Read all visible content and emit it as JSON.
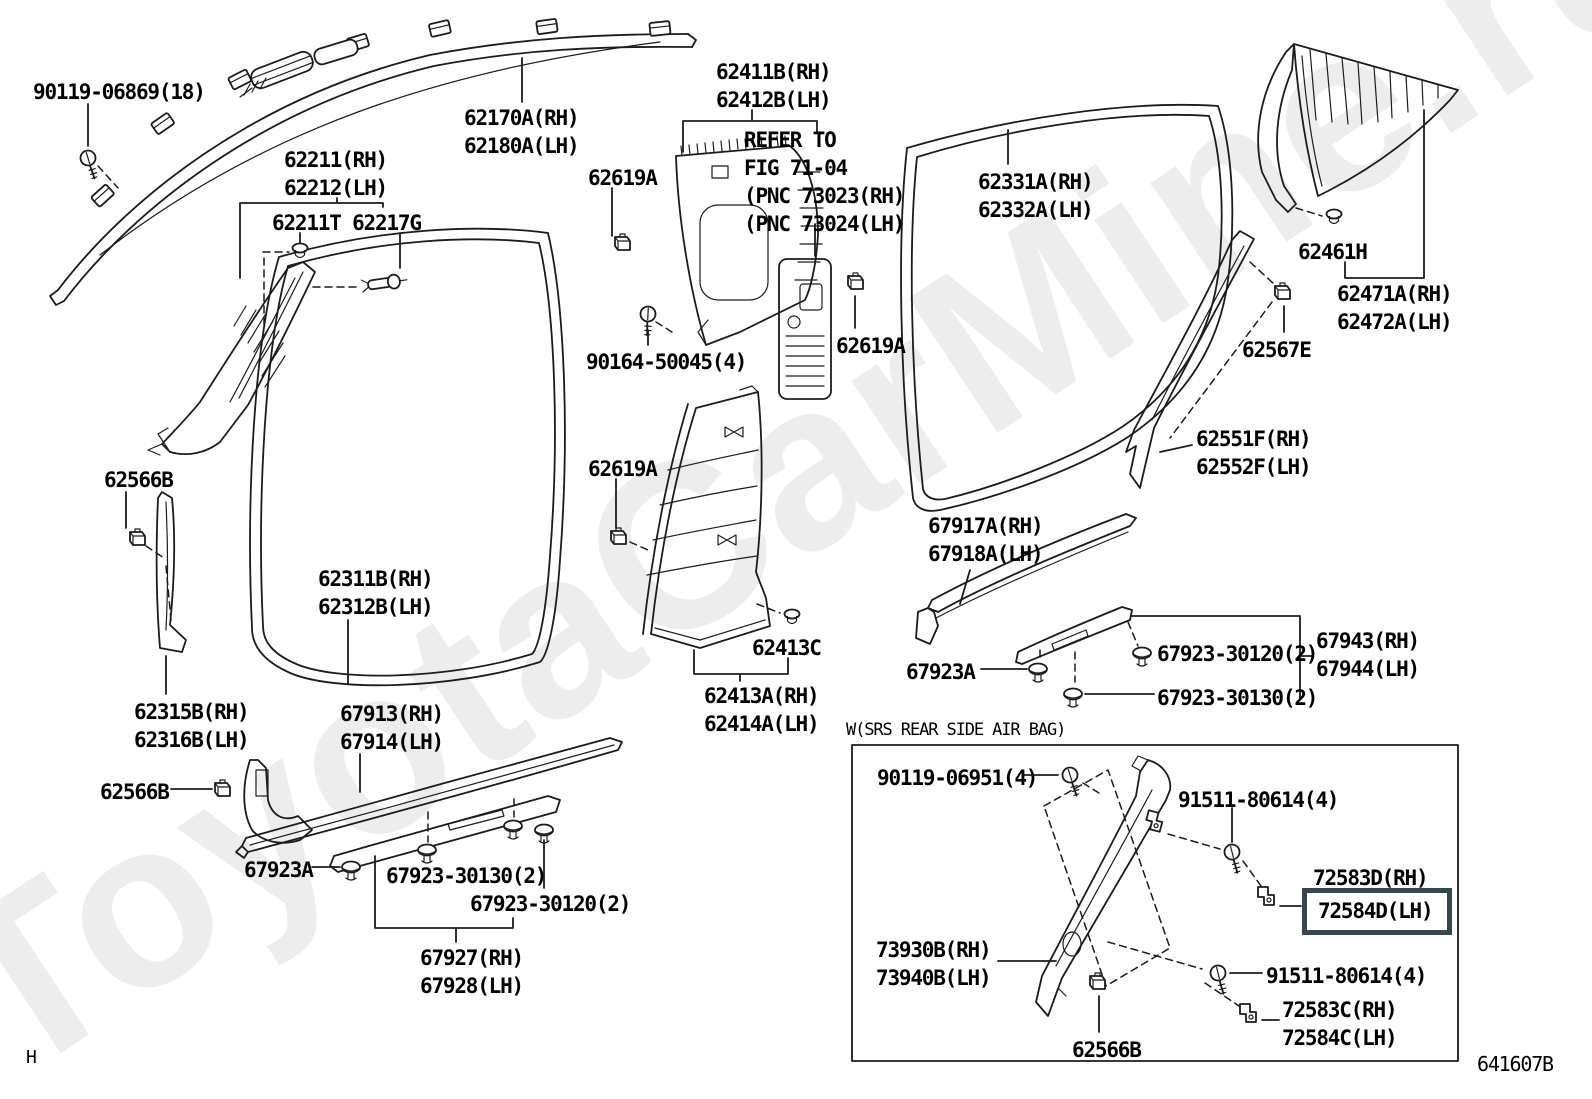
{
  "page": {
    "background": "#ffffff",
    "line_color": "#1c1c1c",
    "watermark_text": "ToyotaCarMine.ru",
    "watermark_color": "#ededed",
    "highlight_box_color": "#37474f",
    "page_code": "641607B",
    "corner_marker": "H"
  },
  "labels": [
    {
      "id": "90119-06869",
      "x": 33,
      "y": 78,
      "style": "part",
      "text": [
        "90119-06869(18)"
      ]
    },
    {
      "id": "62170A-62180A",
      "x": 464,
      "y": 104,
      "style": "part",
      "text": [
        "62170A(RH)",
        "62180A(LH)"
      ]
    },
    {
      "id": "62211-62212",
      "x": 284,
      "y": 146,
      "style": "part",
      "text": [
        "62211(RH)",
        "62212(LH)"
      ]
    },
    {
      "id": "62211T-62217G",
      "x": 272,
      "y": 209,
      "style": "part",
      "text": [
        "62211T 62217G"
      ]
    },
    {
      "id": "62411B-62412B",
      "x": 716,
      "y": 58,
      "style": "part",
      "text": [
        "62411B(RH)",
        "62412B(LH)"
      ]
    },
    {
      "id": "refer-note",
      "x": 744,
      "y": 126,
      "style": "note",
      "text": [
        "REFER TO",
        "FIG 71-04",
        "(PNC 73023(RH)",
        "(PNC 73024(LH)"
      ]
    },
    {
      "id": "62619A-1",
      "x": 588,
      "y": 164,
      "style": "part",
      "text": [
        "62619A"
      ]
    },
    {
      "id": "62331A-62332A",
      "x": 978,
      "y": 168,
      "style": "part",
      "text": [
        "62331A(RH)",
        "62332A(LH)"
      ]
    },
    {
      "id": "62461H",
      "x": 1298,
      "y": 238,
      "style": "part",
      "text": [
        "62461H"
      ]
    },
    {
      "id": "62471A-62472A",
      "x": 1337,
      "y": 280,
      "style": "part",
      "text": [
        "62471A(RH)",
        "62472A(LH)"
      ]
    },
    {
      "id": "62567E",
      "x": 1242,
      "y": 336,
      "style": "part",
      "text": [
        "62567E"
      ]
    },
    {
      "id": "62619A-2",
      "x": 836,
      "y": 332,
      "style": "part",
      "text": [
        "62619A"
      ]
    },
    {
      "id": "90164-50045",
      "x": 586,
      "y": 348,
      "style": "part",
      "text": [
        "90164-50045(4)"
      ]
    },
    {
      "id": "62551F-62552F",
      "x": 1196,
      "y": 425,
      "style": "part",
      "text": [
        "62551F(RH)",
        "62552F(LH)"
      ]
    },
    {
      "id": "62619A-3",
      "x": 588,
      "y": 455,
      "style": "part",
      "text": [
        "62619A"
      ]
    },
    {
      "id": "62566B-1",
      "x": 104,
      "y": 466,
      "style": "part",
      "text": [
        "62566B"
      ]
    },
    {
      "id": "67917A-67918A",
      "x": 928,
      "y": 512,
      "style": "part",
      "text": [
        "67917A(RH)",
        "67918A(LH)"
      ]
    },
    {
      "id": "62311B-62312B",
      "x": 318,
      "y": 565,
      "style": "part",
      "text": [
        "62311B(RH)",
        "62312B(LH)"
      ]
    },
    {
      "id": "62413C",
      "x": 752,
      "y": 634,
      "style": "part",
      "text": [
        "62413C"
      ]
    },
    {
      "id": "67943-67944",
      "x": 1316,
      "y": 627,
      "style": "part",
      "text": [
        "67943(RH)",
        "67944(LH)"
      ]
    },
    {
      "id": "67923-30120-r",
      "x": 1157,
      "y": 640,
      "style": "part",
      "text": [
        "67923-30120(2)"
      ]
    },
    {
      "id": "67923A-r",
      "x": 906,
      "y": 658,
      "style": "part",
      "text": [
        "67923A"
      ]
    },
    {
      "id": "67923-30130-r",
      "x": 1157,
      "y": 684,
      "style": "part",
      "text": [
        "67923-30130(2)"
      ]
    },
    {
      "id": "62413A-62414A",
      "x": 704,
      "y": 682,
      "style": "part",
      "text": [
        "62413A(RH)",
        "62414A(LH)"
      ]
    },
    {
      "id": "62315B-62316B",
      "x": 134,
      "y": 698,
      "style": "part",
      "text": [
        "62315B(RH)",
        "62316B(LH)"
      ]
    },
    {
      "id": "67913-67914",
      "x": 340,
      "y": 700,
      "style": "part",
      "text": [
        "67913(RH)",
        "67914(LH)"
      ]
    },
    {
      "id": "srs-caption",
      "x": 846,
      "y": 720,
      "style": "caption",
      "text": [
        "W(SRS REAR SIDE AIR BAG)"
      ]
    },
    {
      "id": "62566B-2",
      "x": 100,
      "y": 778,
      "style": "part",
      "text": [
        "62566B"
      ]
    },
    {
      "id": "90119-06951",
      "x": 877,
      "y": 764,
      "style": "part",
      "text": [
        "90119-06951(4)"
      ]
    },
    {
      "id": "91511-80614-1",
      "x": 1178,
      "y": 786,
      "style": "part",
      "text": [
        "91511-80614(4)"
      ]
    },
    {
      "id": "67923A-l",
      "x": 244,
      "y": 856,
      "style": "part",
      "text": [
        "67923A"
      ]
    },
    {
      "id": "67923-30130-l",
      "x": 386,
      "y": 862,
      "style": "part",
      "text": [
        "67923-30130(2)"
      ]
    },
    {
      "id": "72583D",
      "x": 1313,
      "y": 864,
      "style": "part",
      "text": [
        "72583D(RH)"
      ]
    },
    {
      "id": "72584D",
      "x": 1318,
      "y": 897,
      "style": "part",
      "text": [
        "72584D(LH)"
      ],
      "highlighted": true
    },
    {
      "id": "67923-30120-l",
      "x": 470,
      "y": 890,
      "style": "part",
      "text": [
        "67923-30120(2)"
      ]
    },
    {
      "id": "73930B-73940B",
      "x": 876,
      "y": 936,
      "style": "part",
      "text": [
        "73930B(RH)",
        "73940B(LH)"
      ]
    },
    {
      "id": "91511-80614-2",
      "x": 1266,
      "y": 962,
      "style": "part",
      "text": [
        "91511-80614(4)"
      ]
    },
    {
      "id": "67927-67928",
      "x": 420,
      "y": 944,
      "style": "part",
      "text": [
        "67927(RH)",
        "67928(LH)"
      ]
    },
    {
      "id": "72583C-72584C",
      "x": 1282,
      "y": 996,
      "style": "part",
      "text": [
        "72583C(RH)",
        "72584C(LH)"
      ]
    },
    {
      "id": "62566B-3",
      "x": 1072,
      "y": 1036,
      "style": "part",
      "text": [
        "62566B"
      ]
    }
  ]
}
